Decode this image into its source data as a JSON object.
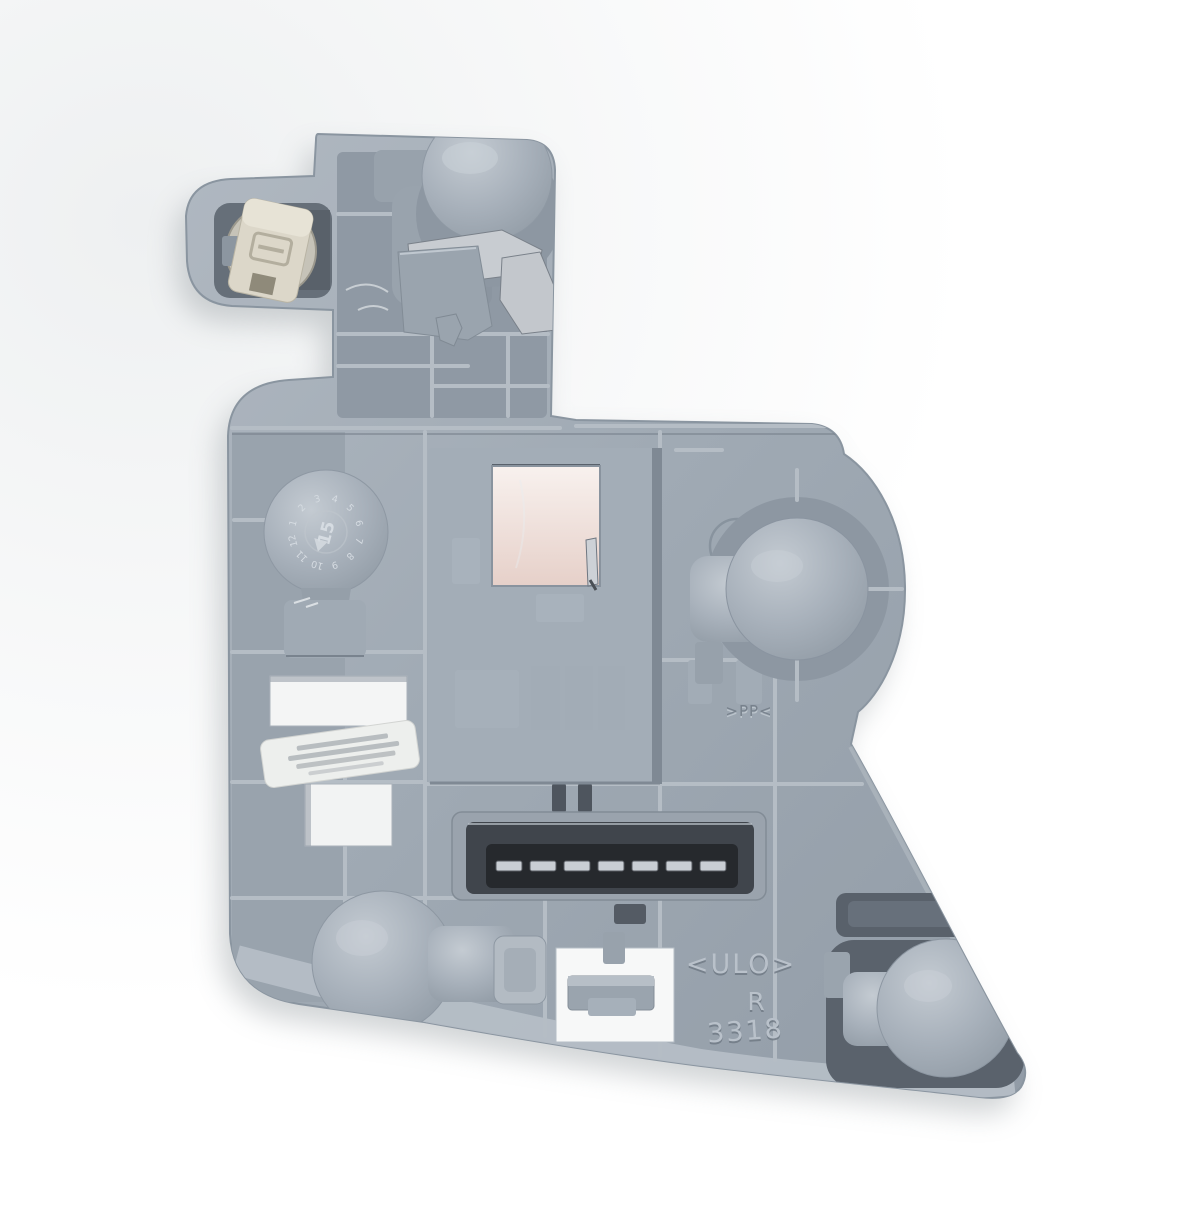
{
  "meta": {
    "type": "product-photo",
    "subject": "Rear tail light bulb holder carrier plate",
    "background": "#ffffff"
  },
  "colors": {
    "plate": "#9aa4ae",
    "plate_light": "#b9c1ca",
    "plate_dark": "#7b8590",
    "recess": "#5a626c",
    "connector_slot": "#26292d",
    "pin_metal": "#c9ced4",
    "socket_insert_cream": "#dcd7c9",
    "reflector_pink": "#ecdad4",
    "window_white": "#f5f6f6",
    "label": "#edefed"
  },
  "markings": {
    "brand": "<ULO>",
    "side": "R",
    "mold_number": "3318",
    "material_code": ">PP<",
    "logo": "mercedes-star",
    "date_wheel": {
      "digits": [
        "1",
        "2",
        "3",
        "4",
        "5",
        "6",
        "7",
        "8",
        "9",
        "10",
        "11",
        "12"
      ],
      "center": "15"
    }
  },
  "label": {
    "present": true,
    "text_lines": 4,
    "legible": false
  },
  "connector": {
    "pin_count": 7
  }
}
